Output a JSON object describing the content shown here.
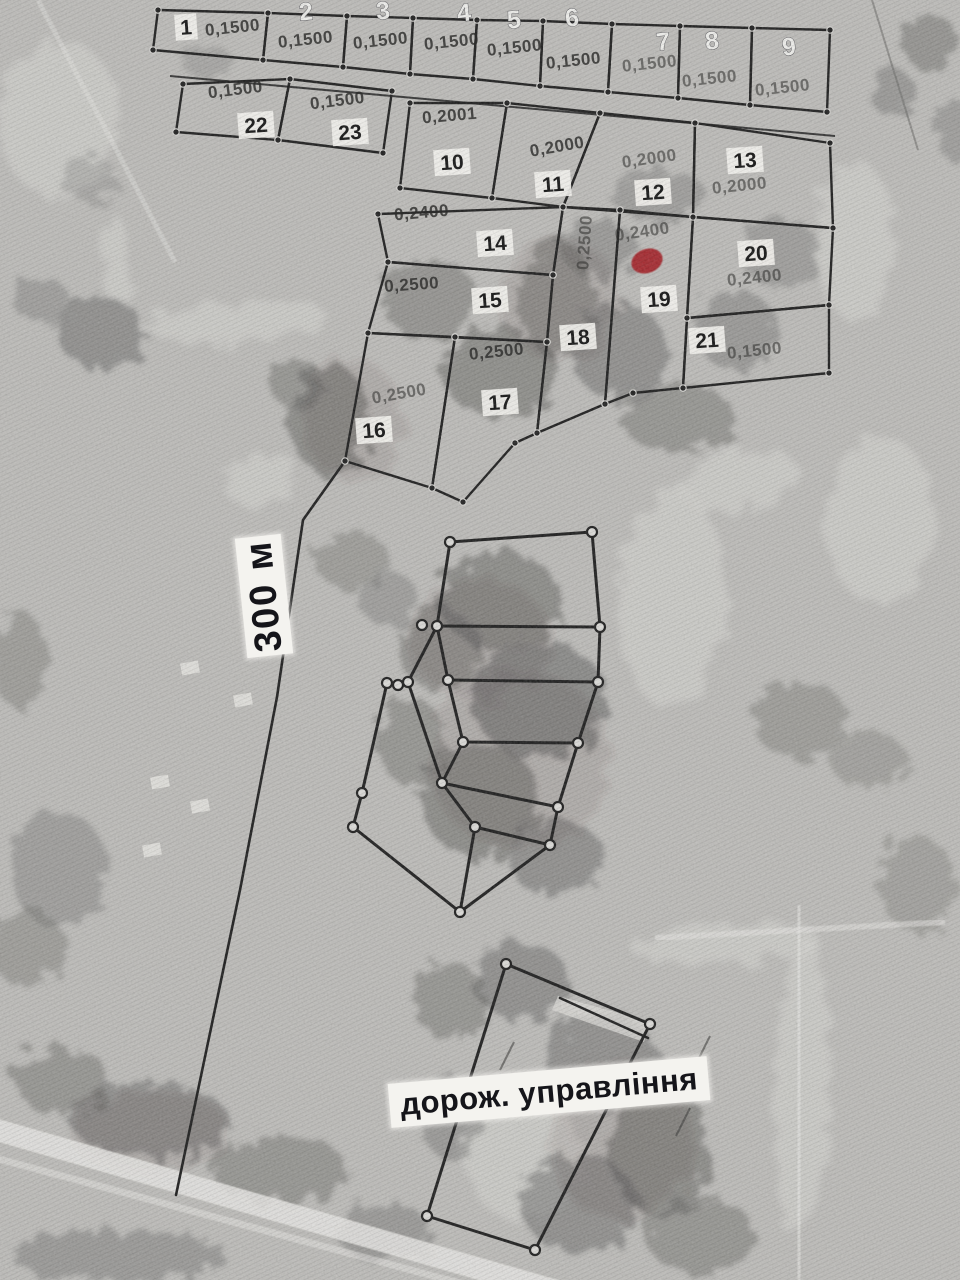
{
  "map": {
    "scale_label": "300 м",
    "annotation": "дорож. управління",
    "colors": {
      "photo_base": "#bdbcb9",
      "line": "#1c1c1c",
      "chip_bg": "#f5f4f0",
      "chip_text": "#121212",
      "area_text": "#2e2e2c",
      "marker": "#a31d23"
    },
    "parcels": [
      {
        "n": "1",
        "a": "0,1500",
        "poly": [
          [
            158,
            10
          ],
          [
            268,
            13
          ],
          [
            263,
            60
          ],
          [
            153,
            50
          ]
        ],
        "np": [
          186,
          27
        ],
        "ns": "chip",
        "ap": [
          233,
          33
        ],
        "ar": -6
      },
      {
        "n": "2",
        "a": "0,1500",
        "poly": [
          [
            268,
            13
          ],
          [
            347,
            16
          ],
          [
            343,
            67
          ],
          [
            263,
            60
          ]
        ],
        "np": [
          306,
          12
        ],
        "ns": "light",
        "ap": [
          306,
          45
        ],
        "ar": -6
      },
      {
        "n": "3",
        "a": "0,1500",
        "poly": [
          [
            347,
            16
          ],
          [
            413,
            18
          ],
          [
            410,
            74
          ],
          [
            343,
            67
          ]
        ],
        "np": [
          383,
          11
        ],
        "ns": "light",
        "ap": [
          381,
          46
        ],
        "ar": -6
      },
      {
        "n": "4",
        "a": "0,1500",
        "poly": [
          [
            413,
            18
          ],
          [
            477,
            20
          ],
          [
            473,
            79
          ],
          [
            410,
            74
          ]
        ],
        "np": [
          464,
          13
        ],
        "ns": "light",
        "ap": [
          452,
          47
        ],
        "ar": -6
      },
      {
        "n": "5",
        "a": "0,1500",
        "poly": [
          [
            477,
            20
          ],
          [
            543,
            21
          ],
          [
            540,
            86
          ],
          [
            473,
            79
          ]
        ],
        "np": [
          514,
          20
        ],
        "ns": "light",
        "ap": [
          515,
          53
        ],
        "ar": -6
      },
      {
        "n": "6",
        "a": "0,1500",
        "poly": [
          [
            543,
            21
          ],
          [
            612,
            24
          ],
          [
            608,
            92
          ],
          [
            540,
            86
          ]
        ],
        "np": [
          572,
          18
        ],
        "ns": "light",
        "ap": [
          574,
          66
        ],
        "ar": -6
      },
      {
        "n": "7",
        "a": "0,1500",
        "poly": [
          [
            612,
            24
          ],
          [
            680,
            26
          ],
          [
            678,
            98
          ],
          [
            608,
            92
          ]
        ],
        "np": [
          663,
          42
        ],
        "ns": "light",
        "ap": [
          650,
          69
        ],
        "ar": -6,
        "af": true
      },
      {
        "n": "8",
        "a": "0,1500",
        "poly": [
          [
            680,
            26
          ],
          [
            752,
            28
          ],
          [
            750,
            105
          ],
          [
            678,
            98
          ]
        ],
        "np": [
          712,
          41
        ],
        "ns": "light",
        "ap": [
          710,
          84
        ],
        "ar": -6,
        "af": true
      },
      {
        "n": "9",
        "a": "0,1500",
        "poly": [
          [
            752,
            28
          ],
          [
            830,
            30
          ],
          [
            827,
            112
          ],
          [
            750,
            105
          ]
        ],
        "np": [
          789,
          47
        ],
        "ns": "light",
        "ap": [
          783,
          93
        ],
        "ar": -6,
        "af": true
      },
      {
        "n": "22",
        "a": "0,1500",
        "poly": [
          [
            183,
            84
          ],
          [
            290,
            79
          ],
          [
            278,
            140
          ],
          [
            176,
            132
          ]
        ],
        "np": [
          256,
          125
        ],
        "ns": "chip",
        "ap": [
          236,
          95
        ],
        "ar": -7
      },
      {
        "n": "23",
        "a": "0,1500",
        "poly": [
          [
            290,
            79
          ],
          [
            392,
            91
          ],
          [
            383,
            153
          ],
          [
            278,
            140
          ]
        ],
        "np": [
          350,
          132
        ],
        "ns": "chip",
        "ap": [
          338,
          106
        ],
        "ar": -7
      },
      {
        "n": "10",
        "a": "0,2001",
        "poly": [
          [
            410,
            103
          ],
          [
            507,
            103
          ],
          [
            492,
            198
          ],
          [
            400,
            188
          ]
        ],
        "np": [
          452,
          162
        ],
        "ns": "chip",
        "ap": [
          450,
          121
        ],
        "ar": -5
      },
      {
        "n": "11",
        "a": "0,2000",
        "poly": [
          [
            507,
            103
          ],
          [
            600,
            113
          ],
          [
            563,
            207
          ],
          [
            492,
            198
          ]
        ],
        "np": [
          553,
          184
        ],
        "ns": "chip",
        "ap": [
          558,
          152
        ],
        "ar": -10
      },
      {
        "n": "12",
        "a": "0,2000",
        "poly": [
          [
            600,
            113
          ],
          [
            695,
            123
          ],
          [
            693,
            217
          ],
          [
            563,
            207
          ]
        ],
        "np": [
          653,
          192
        ],
        "ns": "chip",
        "ap": [
          650,
          164
        ],
        "ar": -8,
        "af": true
      },
      {
        "n": "13",
        "a": "0,2000",
        "poly": [
          [
            695,
            123
          ],
          [
            830,
            143
          ],
          [
            833,
            228
          ],
          [
            693,
            217
          ]
        ],
        "np": [
          745,
          160
        ],
        "ns": "chip",
        "ap": [
          740,
          191
        ],
        "ar": -6,
        "af": true
      },
      {
        "n": "14",
        "a": "0,2400",
        "poly": [
          [
            378,
            214
          ],
          [
            563,
            207
          ],
          [
            553,
            275
          ],
          [
            388,
            262
          ]
        ],
        "np": [
          495,
          243
        ],
        "ns": "chip",
        "ap": [
          422,
          218
        ],
        "ar": -5
      },
      {
        "n": "15",
        "a": "0,2500",
        "poly": [
          [
            388,
            262
          ],
          [
            553,
            275
          ],
          [
            547,
            342
          ],
          [
            368,
            333
          ]
        ],
        "np": [
          490,
          300
        ],
        "ns": "chip",
        "ap": [
          412,
          290
        ],
        "ar": -4
      },
      {
        "n": "16",
        "a": "0,2500",
        "poly": [
          [
            368,
            333
          ],
          [
            455,
            337
          ],
          [
            432,
            488
          ],
          [
            345,
            461
          ]
        ],
        "np": [
          374,
          430
        ],
        "ns": "chip",
        "ap": [
          400,
          399
        ],
        "ar": -10,
        "af": true
      },
      {
        "n": "17",
        "a": "0,2500",
        "poly": [
          [
            455,
            337
          ],
          [
            547,
            342
          ],
          [
            537,
            433
          ],
          [
            515,
            443
          ],
          [
            463,
            502
          ],
          [
            432,
            488
          ]
        ],
        "np": [
          500,
          402
        ],
        "ns": "chip",
        "ap": [
          497,
          357
        ],
        "ar": -6
      },
      {
        "n": "18",
        "a": "0,2500",
        "poly": [
          [
            563,
            207
          ],
          [
            620,
            210
          ],
          [
            605,
            404
          ],
          [
            537,
            433
          ],
          [
            547,
            342
          ],
          [
            553,
            275
          ]
        ],
        "np": [
          578,
          337
        ],
        "ns": "chip",
        "ap": [
          590,
          243
        ],
        "ar": -86,
        "af": true
      },
      {
        "n": "19",
        "a": "0,2400",
        "poly": [
          [
            620,
            210
          ],
          [
            693,
            217
          ],
          [
            687,
            318
          ],
          [
            683,
            388
          ],
          [
            633,
            393
          ],
          [
            605,
            404
          ]
        ],
        "np": [
          659,
          299
        ],
        "ns": "chip",
        "ap": [
          643,
          237
        ],
        "ar": -8,
        "af": true
      },
      {
        "n": "20",
        "a": "0,2400",
        "poly": [
          [
            693,
            217
          ],
          [
            833,
            228
          ],
          [
            829,
            305
          ],
          [
            687,
            318
          ]
        ],
        "np": [
          756,
          253
        ],
        "ns": "chip",
        "ap": [
          755,
          283
        ],
        "ar": -6,
        "af": true
      },
      {
        "n": "21",
        "a": "0,1500",
        "poly": [
          [
            687,
            318
          ],
          [
            829,
            305
          ],
          [
            829,
            373
          ],
          [
            683,
            388
          ]
        ],
        "np": [
          707,
          340
        ],
        "ns": "chip",
        "ap": [
          755,
          356
        ],
        "ar": -6,
        "af": true
      }
    ],
    "marker": {
      "pos": [
        647,
        261
      ],
      "rx": 16,
      "ry": 12,
      "rot": -20
    },
    "mid_cluster": {
      "outer": [
        [
          450,
          542
        ],
        [
          592,
          532
        ],
        [
          600,
          627
        ],
        [
          598,
          682
        ],
        [
          578,
          743
        ],
        [
          558,
          807
        ],
        [
          550,
          845
        ],
        [
          460,
          912
        ],
        [
          353,
          827
        ],
        [
          362,
          793
        ],
        [
          387,
          683
        ],
        [
          398,
          685
        ],
        [
          408,
          682
        ],
        [
          437,
          626
        ]
      ],
      "inner": [
        [
          [
            437,
            626
          ],
          [
            600,
            627
          ]
        ],
        [
          [
            448,
            680
          ],
          [
            598,
            682
          ]
        ],
        [
          [
            463,
            742
          ],
          [
            578,
            743
          ]
        ],
        [
          [
            442,
            783
          ],
          [
            558,
            807
          ]
        ],
        [
          [
            475,
            827
          ],
          [
            550,
            845
          ]
        ],
        [
          [
            437,
            626
          ],
          [
            448,
            680
          ],
          [
            463,
            742
          ],
          [
            442,
            783
          ],
          [
            475,
            827
          ],
          [
            460,
            912
          ]
        ],
        [
          [
            408,
            682
          ],
          [
            442,
            783
          ]
        ]
      ],
      "extra_dots": [
        [
          422,
          625
        ],
        [
          448,
          680
        ],
        [
          463,
          742
        ],
        [
          442,
          783
        ],
        [
          475,
          827
        ]
      ]
    },
    "site": {
      "outer": [
        [
          506,
          964
        ],
        [
          650,
          1024
        ],
        [
          535,
          1250
        ],
        [
          427,
          1216
        ]
      ],
      "inner": [
        [
          [
            560,
            998
          ],
          [
            648,
            1038
          ]
        ]
      ],
      "band": [
        [
          558,
          996
        ],
        [
          650,
          1022
        ],
        [
          644,
          1042
        ],
        [
          552,
          1010
        ]
      ]
    },
    "boundary_road": [
      [
        345,
        461
      ],
      [
        303,
        520
      ],
      [
        277,
        697
      ],
      [
        240,
        890
      ],
      [
        176,
        1195
      ]
    ]
  }
}
